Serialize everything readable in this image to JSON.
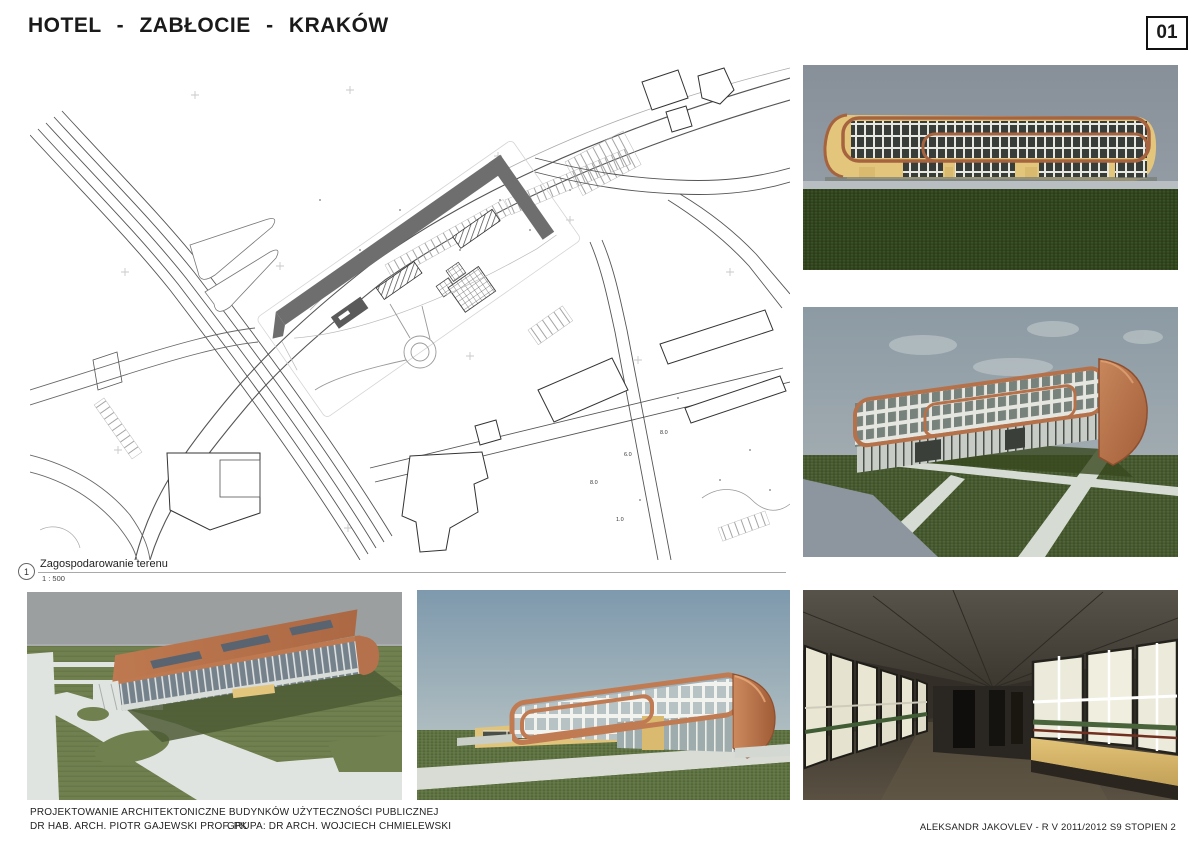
{
  "sheet": {
    "title": "HOTEL - ZABŁOCIE - KRAKÓW",
    "number": "01"
  },
  "site_plan": {
    "caption_number": "1",
    "caption_title": "Zagospodarowanie terenu",
    "caption_scale": "1 : 500",
    "annotations": [
      {
        "text": "8.0"
      },
      {
        "text": "6.0"
      },
      {
        "text": "8.0"
      },
      {
        "text": "1.0"
      }
    ]
  },
  "renders": {
    "top_right": "front-elevation-render",
    "middle_right": "perspective-end-cap-render",
    "bottom_left": "aerial-view-render",
    "bottom_middle": "street-perspective-render",
    "bottom_right": "interior-hall-render"
  },
  "footer": {
    "course": "PROJEKTOWANIE  ARCHITEKTONICZNE  BUDYNKÓW  UŻYTECZNOŚCI  PUBLICZNEJ",
    "tutor": "DR HAB. ARCH. PIOTR GAJEWSKI PROF. PK",
    "group": "GRUPA: DR ARCH. WOJCIECH CHMIELEWSKI",
    "author": "ALEKSANDR JAKOVLEV - R V 2011/2012 S9 STOPIEN 2"
  },
  "palette": {
    "accent_orange": "#B5714A",
    "facade_tan": "#E4C57C",
    "plan_footprint_gray": "#6E6E6E",
    "grass_dark": "#31441E",
    "grass_light": "#70804E",
    "sky_gray": "#8C949D",
    "sky_blue": "#7E99AD",
    "paper": "#FFFFFF",
    "ink": "#1A1A1A"
  }
}
